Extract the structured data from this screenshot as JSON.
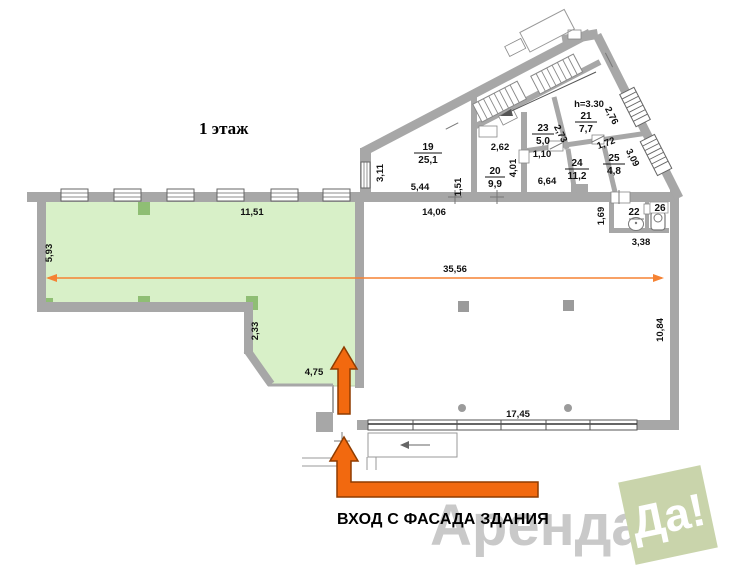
{
  "title": "1 этаж",
  "entrance_text": "ВХОД С ФАСАДА ЗДАНИЯ",
  "watermark": {
    "name": "Аренда",
    "badge": "Да!"
  },
  "colors": {
    "wall_gray": "#a7a7a7",
    "plan_green": "#d8f0c8",
    "pillar_green": "#8fbe74",
    "arrow_orange": "#f2690f",
    "dim_line_orange": "#f58233",
    "watermark_gray": "#c9c9c9",
    "badge_green": "#c9d4ab"
  },
  "rooms": {
    "r19": {
      "num": "19",
      "area": "25,1"
    },
    "r20": {
      "num": "20",
      "area": "9,9"
    },
    "r21": {
      "num": "21",
      "area": "7,7"
    },
    "r23": {
      "num": "23",
      "area": "5,0"
    },
    "r24": {
      "num": "24",
      "area": "11,2"
    },
    "r25": {
      "num": "25",
      "area": "4,8"
    },
    "r22": {
      "num": "22"
    },
    "r26": {
      "num": "26"
    }
  },
  "dims": {
    "green_top": "11,51",
    "green_left": "5,93",
    "green_step": "2,33",
    "green_entry": "4,75",
    "hall_len": "35,56",
    "hall_top": "14,06",
    "hall_front": "17,45",
    "hall_right": "10,84",
    "r19_win": "3,11",
    "r19_bot": "5,44",
    "r19_right": "1,51",
    "r20_top": "2,62",
    "r20_right": "4,01",
    "r23_side": "2,73",
    "r23_door": "1,10",
    "corridor": "6,64",
    "r21_h": "h=3.30",
    "r21_win": "2,76",
    "r25_top": "1,72",
    "r25_win": "3,09",
    "wc_left": "1,69",
    "wc_bot": "3,38"
  }
}
